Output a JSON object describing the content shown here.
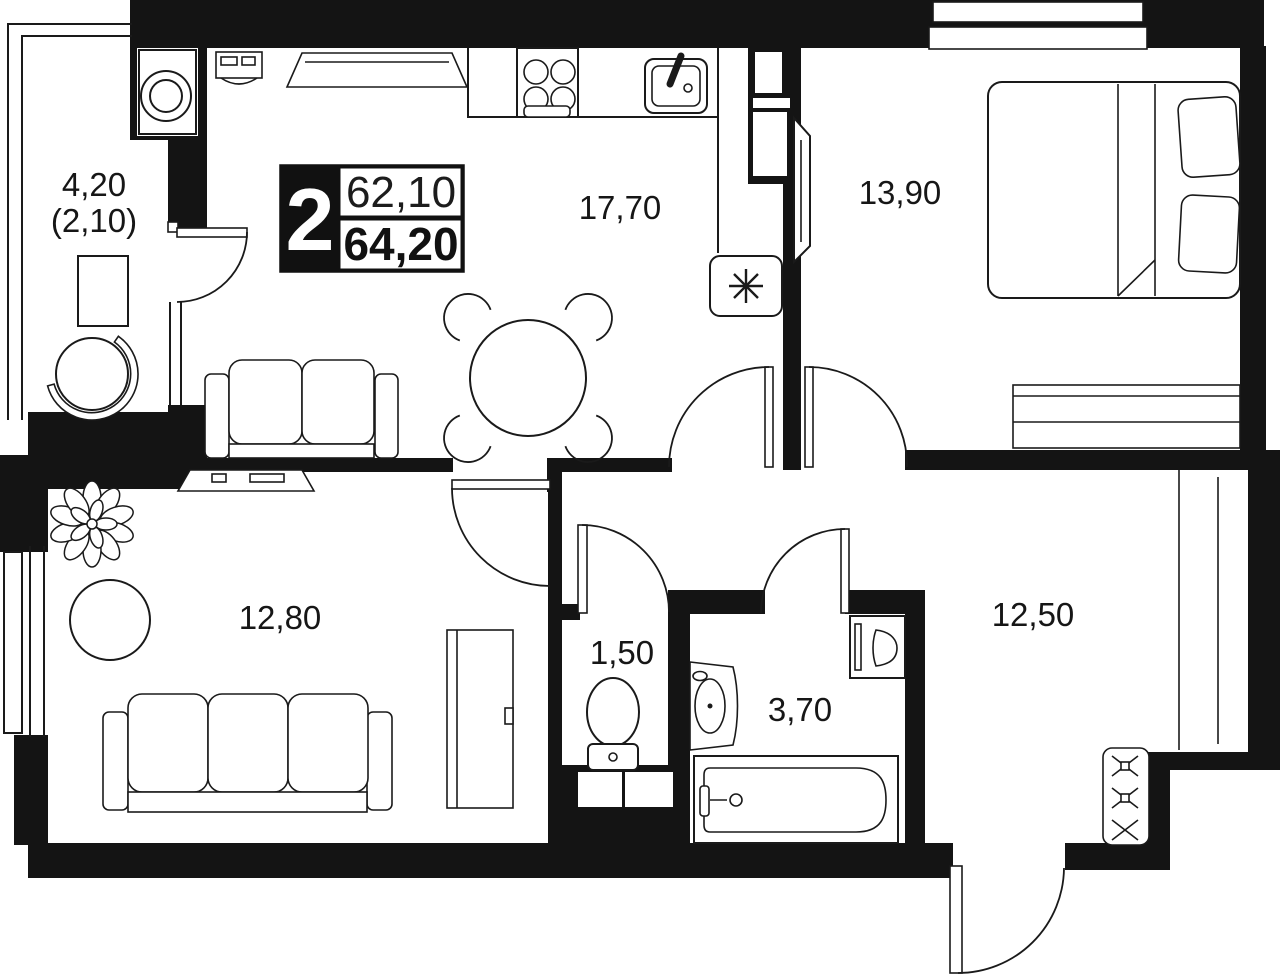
{
  "floor_plan": {
    "unit_badge": {
      "rooms_count": "2",
      "area_living": "62,10",
      "area_total": "64,20"
    },
    "rooms": [
      {
        "name": "balcony",
        "area": "4,20",
        "area_note": "(2,10)"
      },
      {
        "name": "kitchen-living-room",
        "area": "17,70"
      },
      {
        "name": "bedroom",
        "area": "13,90"
      },
      {
        "name": "living-room",
        "area": "12,80"
      },
      {
        "name": "wc",
        "area": "1,50"
      },
      {
        "name": "bathroom",
        "area": "3,70"
      },
      {
        "name": "second-room",
        "area": "12,50"
      }
    ],
    "icons": {
      "refrigerator_marker": "✳",
      "closet_cross": "✕"
    },
    "colors": {
      "walls": "#141414",
      "lines": "#1a1a1a",
      "background": "#ffffff"
    }
  }
}
